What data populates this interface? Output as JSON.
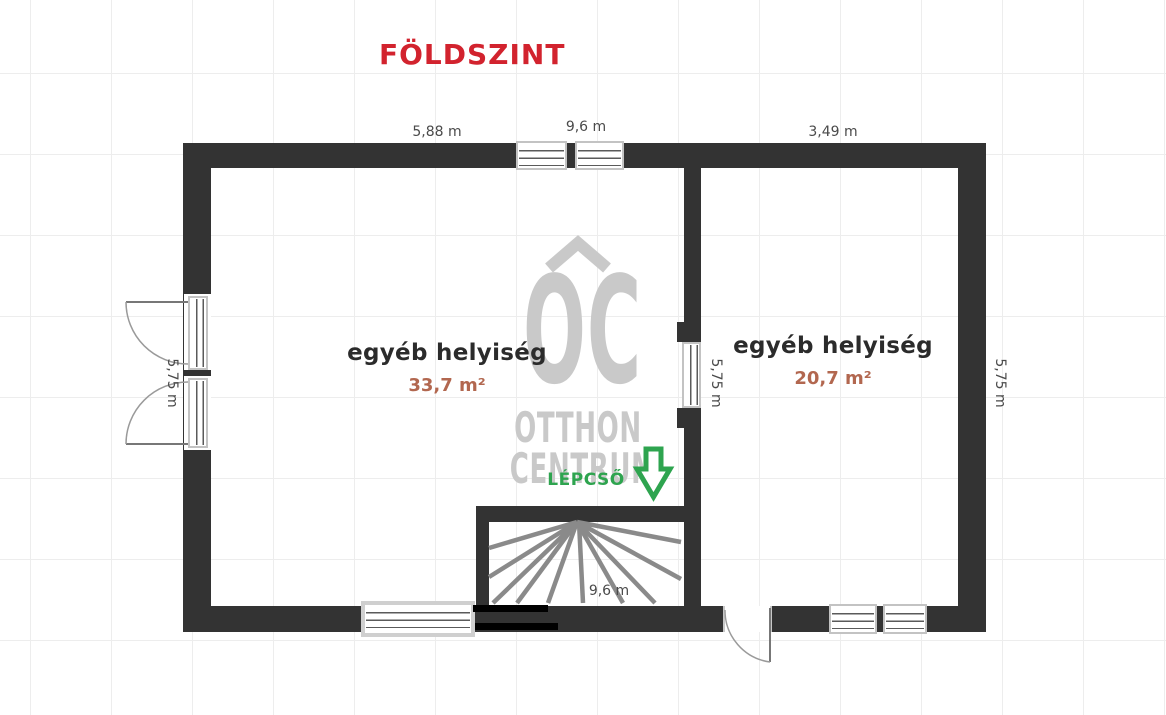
{
  "title": "FÖLDSZINT",
  "colors": {
    "title": "#d2232e",
    "wall": "#333333",
    "room_name": "#2b2b2b",
    "area": "#b2674f",
    "dimension": "#4a4a4a",
    "stairs_green": "#2ea44f",
    "watermark": "#c9c9c9",
    "stair_line": "#8a8a8a"
  },
  "rooms": [
    {
      "name": "egyéb helyiség",
      "area": "33,7 m²"
    },
    {
      "name": "egyéb helyiség",
      "area": "20,7 m²"
    }
  ],
  "dimensions": {
    "top_left": "5,88 m",
    "top_center": "9,6 m",
    "top_right": "3,49 m",
    "left_height": "5,75 m",
    "middle_height": "5,75 m",
    "right_height": "5,75 m",
    "stairs_width": "9,6 m"
  },
  "stairs": {
    "label": "LÉPCSŐ"
  },
  "watermark": {
    "logo": "OC",
    "line1": "OTTHON",
    "line2": "CENTRUM"
  }
}
